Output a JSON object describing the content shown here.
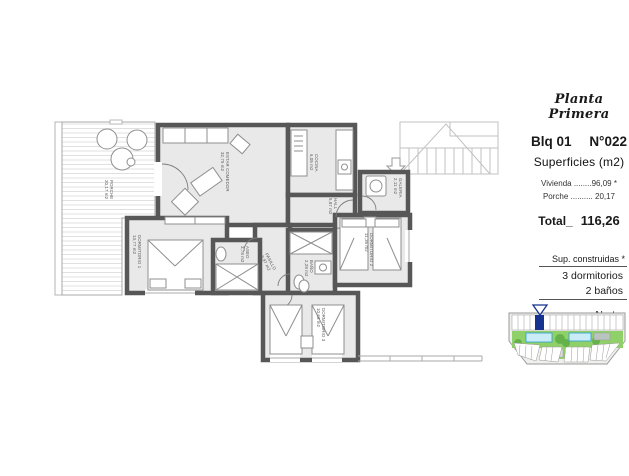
{
  "panel": {
    "plan_name": "Planta Primera",
    "block": "Blq 01",
    "unit_number": "N°022",
    "surfaces_title": "Superficies (m2)",
    "line_vivienda": "Vivienda ........96,09 *",
    "line_porche": "Porche .......... 20,17",
    "total_label": "Total_",
    "total_value": "116,26",
    "built_note": "Sup. construidas *",
    "bedrooms": "3 dormitorios",
    "baths": "2 baños",
    "north_label": "Norte"
  },
  "plan": {
    "rooms": [
      {
        "name": "PORCHE",
        "area": "20,17 m2"
      },
      {
        "name": "ESTAR COMEDOR",
        "area": "32,75 m2"
      },
      {
        "name": "COCINA",
        "area": "6,05 m2"
      },
      {
        "name": "HALL",
        "area": "5,87 m2"
      },
      {
        "name": "GALERIA",
        "area": "2,11 m2"
      },
      {
        "name": "DORMITORIO 1",
        "area": "13,77 m2"
      },
      {
        "name": "DORMITORIO 2",
        "area": "11,35 m2"
      },
      {
        "name": "DORMITORIO 3",
        "area": "10,66 m2"
      },
      {
        "name": "ASEO",
        "area": "3,78 m2"
      },
      {
        "name": "BAÑO",
        "area": "2,28 m2"
      },
      {
        "name": "PASILLO",
        "area": "3,97 m2"
      }
    ]
  },
  "colors": {
    "wall": "#575757",
    "floor": "#e9e9e9",
    "light_line": "#c2c2c2",
    "lawn": "#8fd069",
    "pool": "#c9ecf7",
    "pool_edge": "#2e9fd6",
    "highlight_unit": "#16338f"
  }
}
